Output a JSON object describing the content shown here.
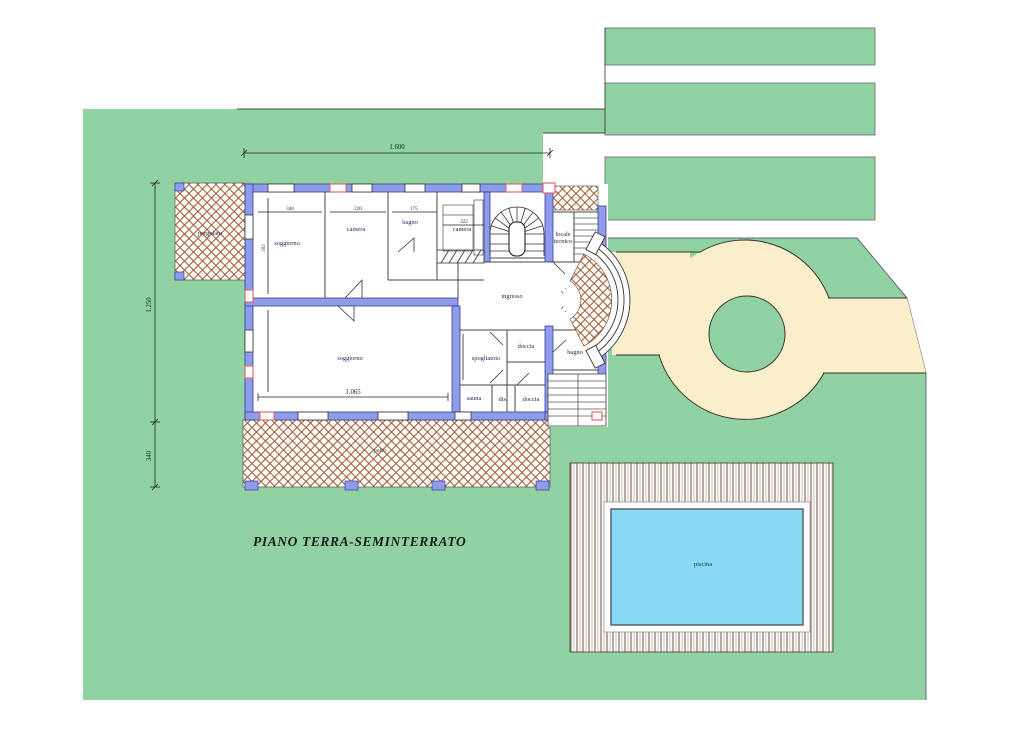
{
  "drawing": {
    "title": "PIANO TERRA-SEMINTERRATO",
    "rooms": {
      "soggiorno_upper": "soggiorno",
      "camera_1": "camera",
      "bagno_upper": "bagno",
      "camera_2": "camera",
      "locale_tecnico_line1": "locale",
      "locale_tecnico_line2": "tecnico",
      "ingresso": "ingresso",
      "soggiorno_lower": "soggiorno",
      "spogliatoio": "spogliatoio",
      "doccia_upper": "doccia",
      "bagno_lower": "bagno",
      "sauna": "sauna",
      "disimpegno": "dis.",
      "doccia_lower": "doccia"
    },
    "outdoor": {
      "pergolato": "pergolato",
      "patio": "patio",
      "piscina": "piscina"
    },
    "dimensions": {
      "overall_width": "1.600",
      "left_height_upper": "1.250",
      "left_height_lower": "340",
      "room_width_1": "340",
      "room_width_2": "220",
      "room_width_3": "175",
      "room_width_4": "322",
      "soggiorno_upper_height": "302",
      "soggiorno_lower_width": "1.065"
    },
    "colors": {
      "lawn_green": "#90d2a2",
      "driveway_cream": "#faeecb",
      "pool_blue": "#88d9f4",
      "wall_blue": "#8d9dea",
      "hatch_brown": "#a86038",
      "accent_red": "#e06a6a"
    }
  }
}
